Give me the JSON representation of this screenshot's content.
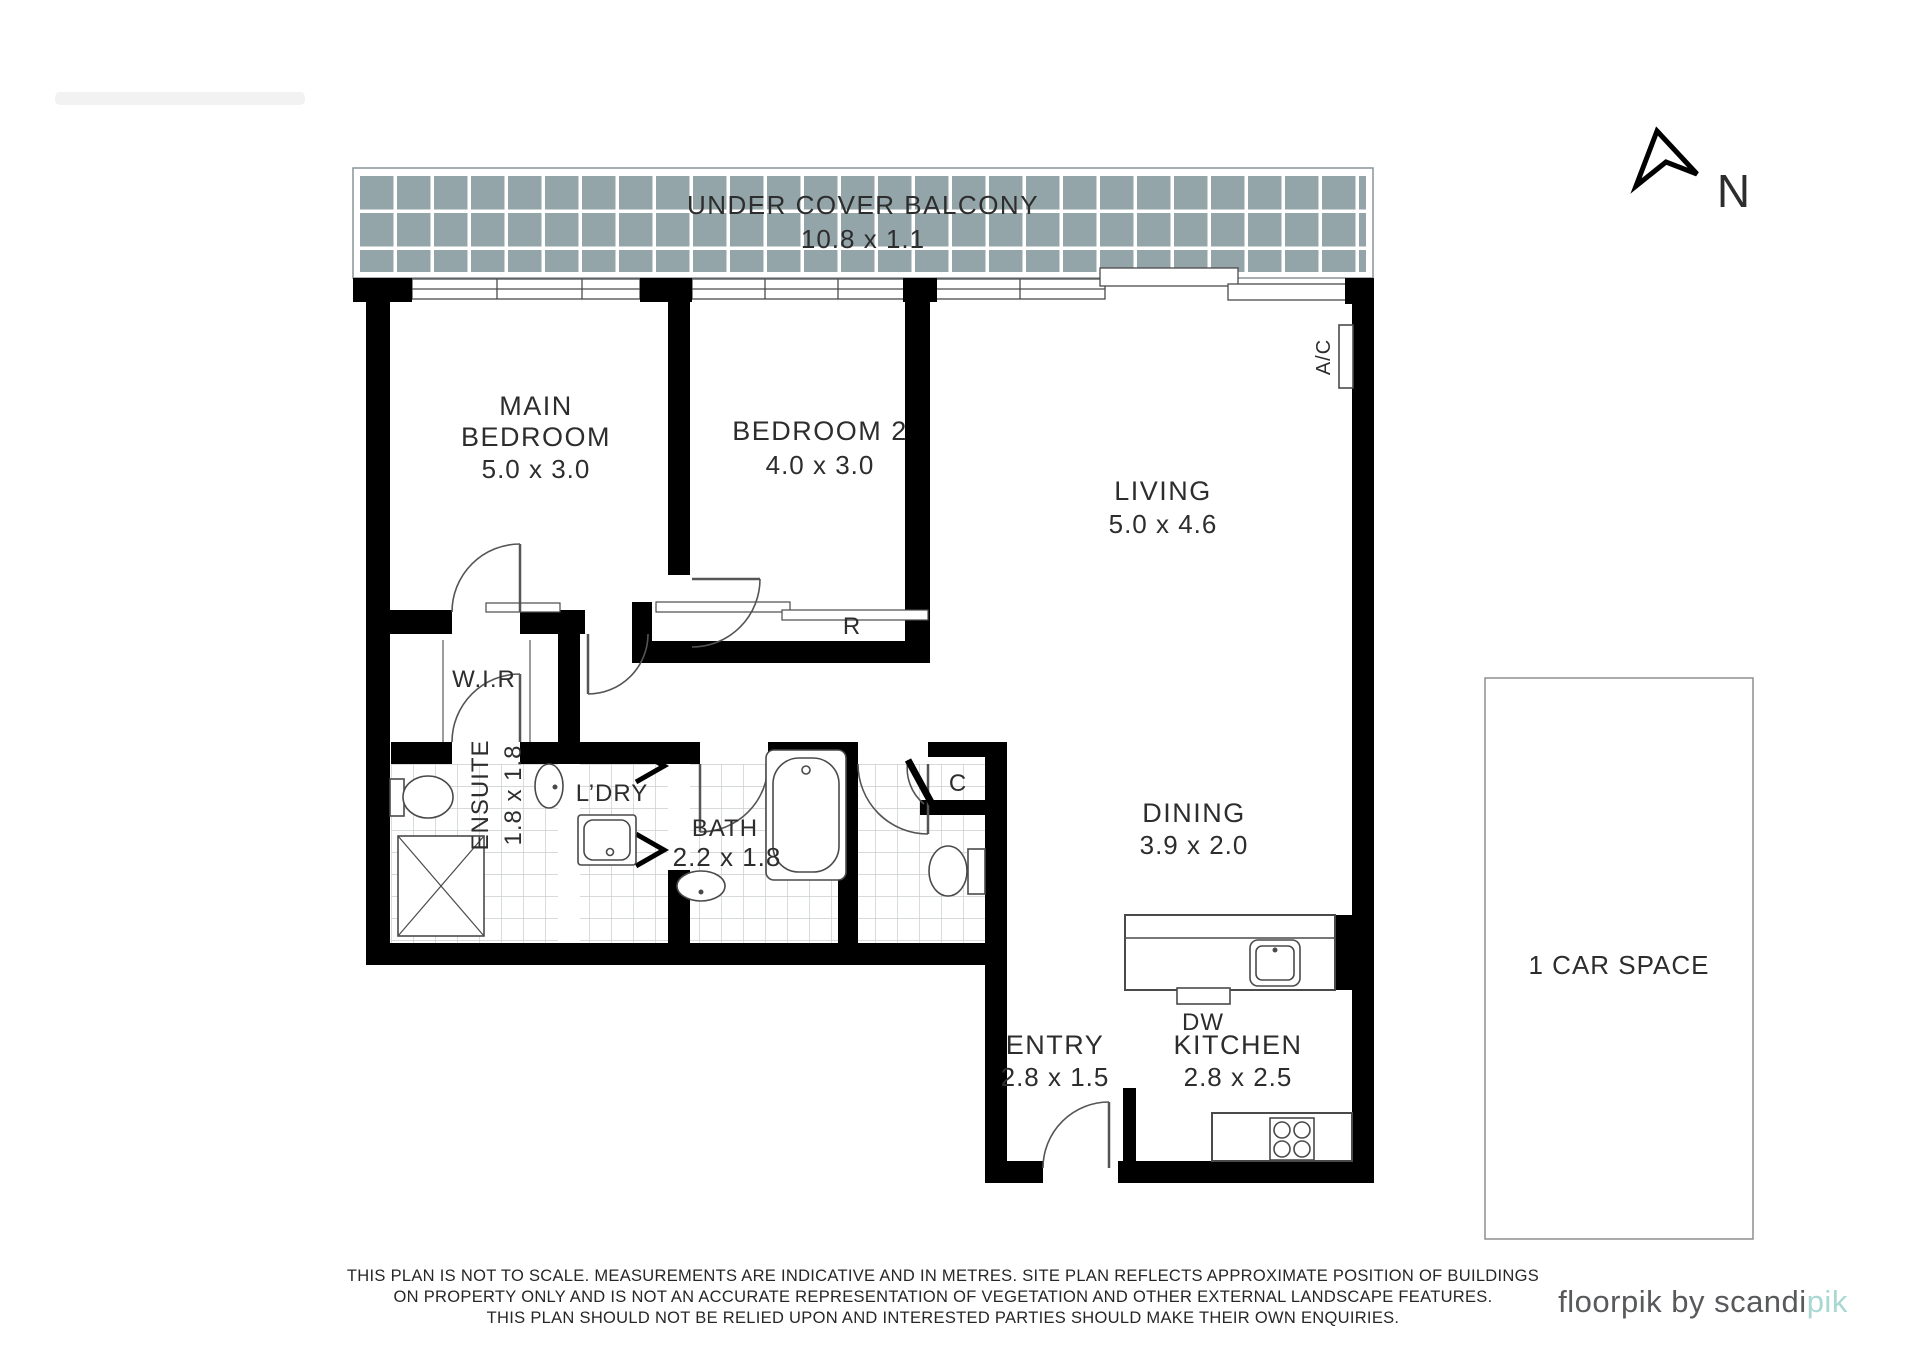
{
  "colors": {
    "wall": "#000000",
    "balcony_tile": "#94a5aa",
    "tile_grout": "#ffffff",
    "floor_tile_line": "#c9ced0",
    "outline": "#4a4a4a",
    "text": "#2d2d2d",
    "logo_text": "#58595b",
    "logo_accent": "#a9d7d3"
  },
  "balcony": {
    "label": "UNDER COVER BALCONY",
    "dims": "10.8 x 1.1"
  },
  "rooms": {
    "main_bedroom": {
      "name_line1": "MAIN",
      "name_line2": "BEDROOM",
      "dims": "5.0 x 3.0"
    },
    "bedroom2": {
      "name": "BEDROOM 2",
      "dims": "4.0 x 3.0"
    },
    "living": {
      "name": "LIVING",
      "dims": "5.0 x 4.6"
    },
    "dining": {
      "name": "DINING",
      "dims": "3.9 x 2.0"
    },
    "kitchen": {
      "name": "KITCHEN",
      "dims": "2.8 x 2.5"
    },
    "entry": {
      "name": "ENTRY",
      "dims": "2.8 x 1.5"
    },
    "bath": {
      "name": "BATH",
      "dims": "2.2 x 1.8"
    },
    "ensuite": {
      "name": "ENSUITE",
      "dims": "1.8 x 1.8"
    },
    "wir": {
      "name": "W.I.R"
    },
    "laundry": {
      "name": "L’DRY"
    },
    "robe": {
      "name": "R"
    },
    "cupboard": {
      "name": "C"
    },
    "ac_unit": {
      "name": "A/C"
    },
    "dishwasher": {
      "name": "DW"
    },
    "car_space": {
      "name": "1 CAR SPACE"
    }
  },
  "compass": {
    "north": "N"
  },
  "footer": {
    "disclaimer_line1": "THIS PLAN IS NOT TO SCALE. MEASUREMENTS ARE INDICATIVE AND IN METRES. SITE PLAN REFLECTS APPROXIMATE POSITION OF BUILDINGS",
    "disclaimer_line2": "ON PROPERTY ONLY AND IS NOT AN ACCURATE REPRESENTATION OF VEGETATION AND OTHER EXTERNAL LANDSCAPE FEATURES.",
    "disclaimer_line3": "THIS PLAN SHOULD NOT BE RELIED UPON AND INTERESTED PARTIES SHOULD MAKE THEIR OWN ENQUIRIES.",
    "brand_prefix": "floorpik by scandi",
    "brand_suffix": "pik"
  }
}
